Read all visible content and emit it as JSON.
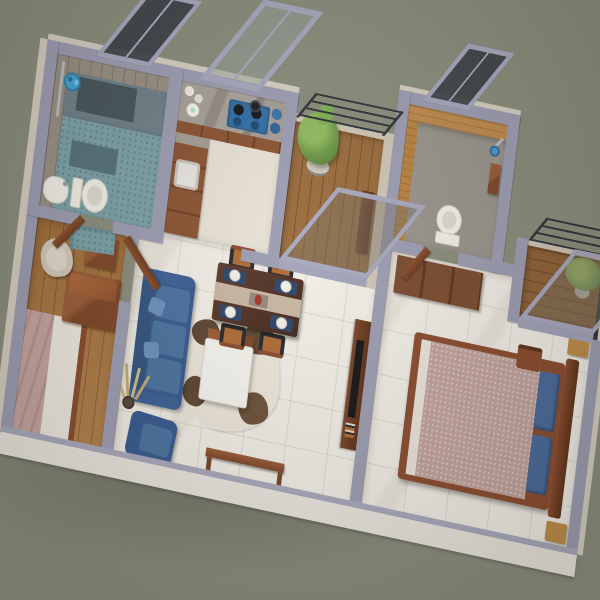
{
  "scene": {
    "title": "3D aerial render of an apartment floor plan",
    "view": "top-down three-quarter perspective",
    "background_color": "#8a8c7b",
    "palette": {
      "wall_top": "#9d9db3",
      "wall_outer": "#d8cfc2",
      "cut_wall_white": "#ece7e0",
      "marble_floor": "#f3efe8",
      "bedroom_wood_floor": "#a9743f",
      "balcony_wood": "#9a6a3a",
      "furniture_wood": "#8a4c2c",
      "dark_wood": "#6b3a22",
      "sofa_blue": "#49719f",
      "pillow_blue": "#48699b",
      "bed_mauve": "#c3a29c",
      "bathroom_teal_floor": "#7ca2a8",
      "bathroom_tan_tile": "#c08a4c",
      "plant_green": "#6e9a46",
      "glass_frame": "#a8a8bf",
      "railing_dark": "#2e3338",
      "hob_blue": "#2f6fa8",
      "accent_red": "#a82f28",
      "rug_ivory": "#eee6da",
      "rug_patch_brown": "#5c4430"
    },
    "rooms": [
      {
        "id": "bathroom-1",
        "label": "Bathroom 1 - ensuite with shower"
      },
      {
        "id": "kitchen",
        "label": "Kitchen"
      },
      {
        "id": "balcony-1",
        "label": "Balcony with potted plant"
      },
      {
        "id": "bathroom-2",
        "label": "Bathroom 2"
      },
      {
        "id": "bedroom-1",
        "label": "Bedroom 1"
      },
      {
        "id": "living-dining",
        "label": "Living and dining room"
      },
      {
        "id": "bedroom-master",
        "label": "Master bedroom"
      },
      {
        "id": "balcony-2",
        "label": "Master bedroom balcony"
      }
    ],
    "furniture": {
      "bathroom_1": [
        "shower area",
        "blue shower caddy",
        "toilet",
        "pedestal sink",
        "dark bath mat",
        "window"
      ],
      "kitchen": [
        "L-shaped marble counter",
        "wooden cabinets",
        "sink",
        "blue gas hob with pots",
        "blue jars",
        "paper towel roll",
        "white canisters",
        "tall window"
      ],
      "balcony_1": [
        "potted plant",
        "metal railing",
        "sliding glass door"
      ],
      "bathroom_2": [
        "toilet",
        "shower head",
        "window",
        "wooden shelf"
      ],
      "bedroom_1": [
        "double bed with mauve blanket",
        "wooden chest",
        "nightstand",
        "beige armchair",
        "open wooden door"
      ],
      "living_dining": [
        "blue 3-seat sofa",
        "blue armchair",
        "white coffee table",
        "cowhide rug",
        "pampas plant",
        "dining table for four",
        "blue placemats",
        "white plates",
        "red bottle",
        "console table",
        "TV console",
        "TV"
      ],
      "bedroom_master": [
        "double bed with speckled mauve duvet",
        "two blue pillows",
        "wooden headboard",
        "wardrobe",
        "bedside stools",
        "wooden chair",
        "sliding glass door"
      ],
      "balcony_2": [
        "potted plant",
        "metal railing"
      ]
    }
  }
}
